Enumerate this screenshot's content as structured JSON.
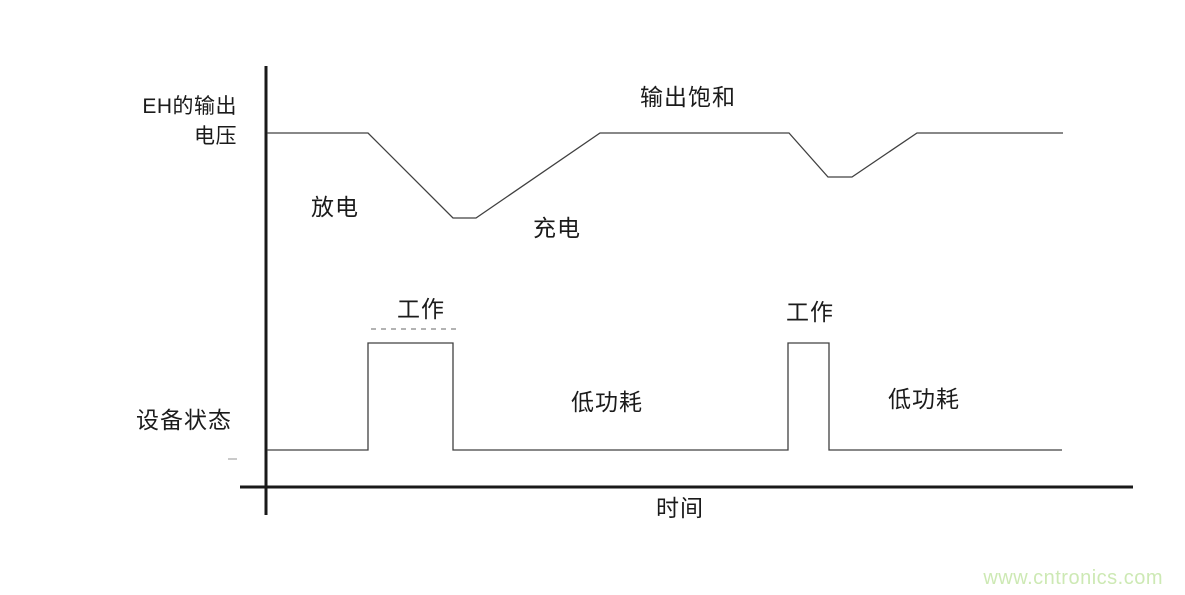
{
  "page": {
    "background": "#ffffff"
  },
  "chart_data": {
    "type": "line",
    "title": "",
    "xlabel": "时间",
    "ylabels": [
      "EH的输出电压",
      "设备状态"
    ],
    "coordinate_units": "px",
    "grid": false,
    "legend": false,
    "series": [
      {
        "id": "voltage-waveform",
        "name": "EH_output_voltage",
        "points": [
          [
            267,
            133
          ],
          [
            368,
            133
          ],
          [
            453,
            218
          ],
          [
            476,
            218
          ],
          [
            600,
            133
          ],
          [
            789,
            133
          ],
          [
            828,
            177
          ],
          [
            852,
            177
          ],
          [
            917,
            133
          ],
          [
            1063,
            133
          ]
        ]
      },
      {
        "id": "device-state-waveform",
        "name": "device_state",
        "points": [
          [
            267,
            450
          ],
          [
            368,
            450
          ],
          [
            368,
            343
          ],
          [
            453,
            343
          ],
          [
            453,
            450
          ],
          [
            788,
            450
          ],
          [
            788,
            343
          ],
          [
            829,
            343
          ],
          [
            829,
            450
          ],
          [
            1062,
            450
          ]
        ]
      }
    ],
    "annotations": [
      {
        "text": "EH的输出\n电压",
        "x": 237,
        "y": 92,
        "align": "right"
      },
      {
        "text": "输出饱和",
        "x": 640,
        "y": 84
      },
      {
        "text": "放电",
        "x": 311,
        "y": 194
      },
      {
        "text": "充电",
        "x": 533,
        "y": 215
      },
      {
        "text": "工作",
        "x": 397,
        "y": 296
      },
      {
        "text": "工作",
        "x": 786,
        "y": 299
      },
      {
        "text": "低功耗",
        "x": 571,
        "y": 389
      },
      {
        "text": "低功耗",
        "x": 888,
        "y": 386
      },
      {
        "text": "设备状态",
        "x": 136,
        "y": 407
      },
      {
        "text": "时间",
        "x": 656,
        "y": 495
      }
    ]
  },
  "diagram": {
    "axis_color": "#1a1a1a",
    "line_color": "#404040",
    "ghost_color": "#9a9a9a",
    "tick_color": "#b3b3b3",
    "y_axis": {
      "x": 266,
      "y1": 66,
      "y2": 515,
      "width": 3
    },
    "x_axis": {
      "y": 487,
      "x1": 240,
      "x2": 1133,
      "width": 3
    },
    "ghost_dash": {
      "x1": 371,
      "y1": 329,
      "x2": 458,
      "y2": 329
    },
    "tick_dash": {
      "x1": 228,
      "y1": 459,
      "x2": 237,
      "y2": 459
    }
  },
  "watermark": {
    "text": "www.cntronics.com",
    "color": "#cde9b4"
  }
}
